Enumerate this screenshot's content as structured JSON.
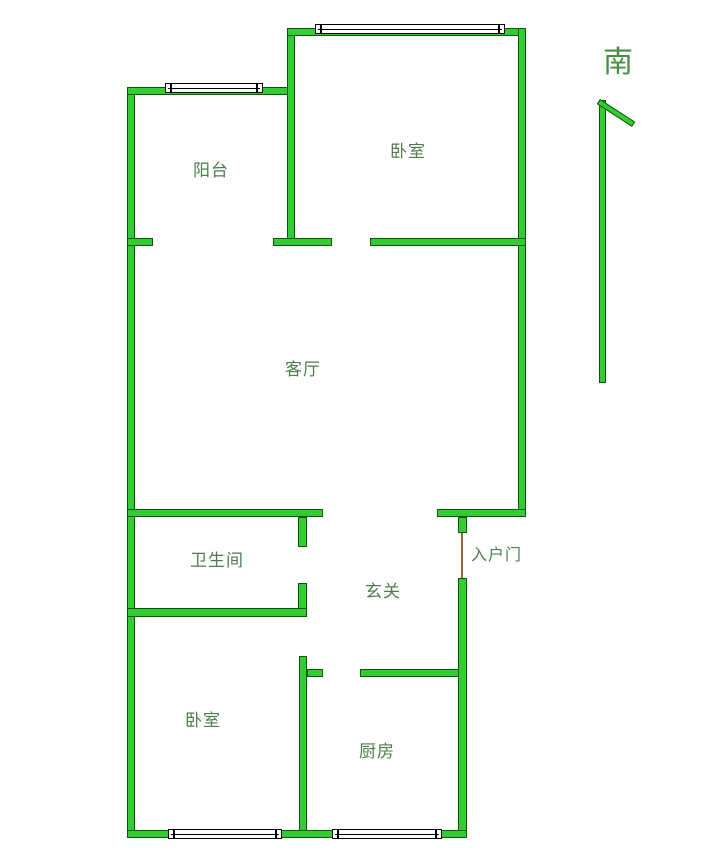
{
  "floorplan": {
    "compass": {
      "direction_label": "南"
    },
    "rooms": [
      {
        "id": "balcony",
        "label": "阳台"
      },
      {
        "id": "bedroom-top",
        "label": "卧室"
      },
      {
        "id": "living-room",
        "label": "客厅"
      },
      {
        "id": "bathroom",
        "label": "卫生间"
      },
      {
        "id": "foyer",
        "label": "玄关"
      },
      {
        "id": "entry-door",
        "label": "入户门"
      },
      {
        "id": "bedroom-bottom",
        "label": "卧室"
      },
      {
        "id": "kitchen",
        "label": "厨房"
      }
    ],
    "colors": {
      "wall_fill": "#33cc33",
      "wall_outline": "#0c570c",
      "label_text": "#4e7e4e",
      "compass_text": "#449044",
      "door_line": "#996633",
      "window_fill": "#ffffff",
      "window_outline": "#000000",
      "background": "#ffffff"
    }
  }
}
